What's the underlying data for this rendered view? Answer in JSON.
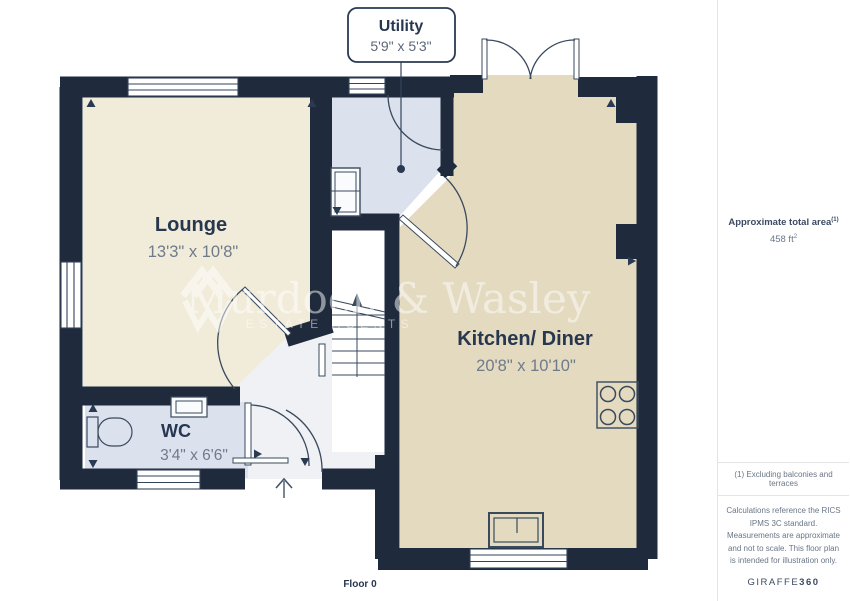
{
  "plan": {
    "floor_label": "Floor 0",
    "rooms": {
      "lounge": {
        "name": "Lounge",
        "dims": "13'3\" x 10'8\""
      },
      "kitchen": {
        "name": "Kitchen/ Diner",
        "dims": "20'8\" x 10'10\""
      },
      "wc": {
        "name": "WC",
        "dims": "3'4\" x 6'6\""
      },
      "utility": {
        "name": "Utility",
        "dims": "5'9\" x 5'3\""
      }
    },
    "watermark": {
      "name": "Murdoch & Wasley",
      "tagline": "ESTATE AGENTS"
    },
    "colors": {
      "wall": "#1F2B3D",
      "lounge": "#F1EBD9",
      "kitchen": "#E3DABF",
      "wet_room": "#DCE1EE",
      "hall": "#EFF1F4"
    }
  },
  "sidebar": {
    "area_title": "Approximate total area",
    "area_title_sup": "(1)",
    "area_value": "458 ft",
    "area_value_sup": "2",
    "footnote": "(1) Excluding balconies and terraces",
    "disclaimer": "Calculations reference the RICS IPMS 3C standard. Measurements are approximate and not to scale. This floor plan is intended for illustration only.",
    "brand_name": "GIRAFFE",
    "brand_suffix": "360"
  }
}
